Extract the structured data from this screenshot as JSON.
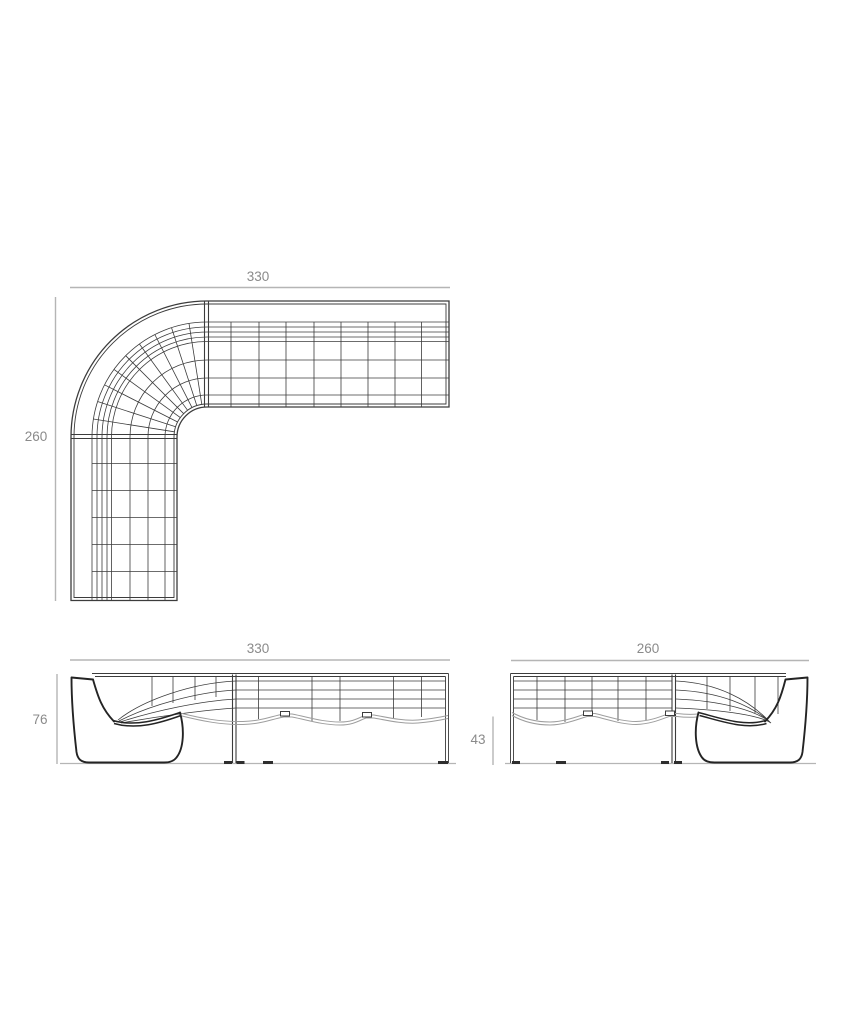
{
  "drawing": {
    "type": "technical-dimension-drawing",
    "subject": "modular curved corner sofa",
    "colors": {
      "background": "#ffffff",
      "line": "#3c3c3c",
      "profile_line": "#242424",
      "soft_line": "#9e9e9e",
      "dim_line": "#b5b5b5",
      "dim_text": "#8a8a8a"
    },
    "views": {
      "plan": {
        "width_cm": "330",
        "depth_cm": "260"
      },
      "front_elevation": {
        "width_cm": "330",
        "height_cm": "76"
      },
      "side_elevation": {
        "width_cm": "260",
        "seat_height_cm": "43"
      }
    }
  }
}
